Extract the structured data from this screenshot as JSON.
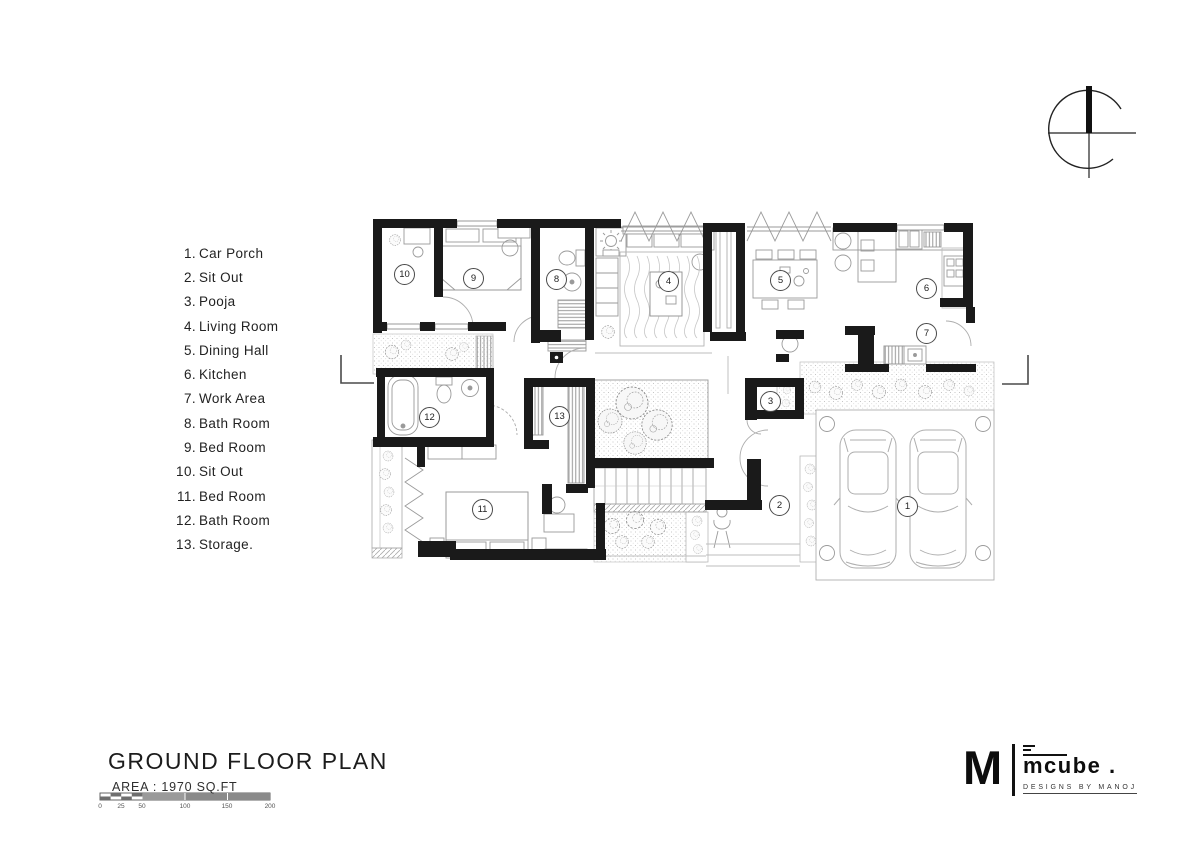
{
  "legend": {
    "items": [
      {
        "number": "1.",
        "name": "Car Porch"
      },
      {
        "number": "2.",
        "name": "Sit Out"
      },
      {
        "number": "3.",
        "name": "Pooja"
      },
      {
        "number": "4.",
        "name": "Living Room"
      },
      {
        "number": "5.",
        "name": "Dining Hall"
      },
      {
        "number": "6.",
        "name": "Kitchen"
      },
      {
        "number": "7.",
        "name": "Work Area"
      },
      {
        "number": "8.",
        "name": "Bath Room"
      },
      {
        "number": "9.",
        "name": "Bed Room"
      },
      {
        "number": "10.",
        "name": "Sit Out"
      },
      {
        "number": "11.",
        "name": "Bed Room"
      },
      {
        "number": "12.",
        "name": "Bath Room"
      },
      {
        "number": "13.",
        "name": "Storage."
      }
    ]
  },
  "plan": {
    "room_tags": [
      "1",
      "2",
      "3",
      "4",
      "5",
      "6",
      "7",
      "8",
      "9",
      "10",
      "11",
      "12",
      "13"
    ]
  },
  "title_block": {
    "title": "GROUND FLOOR PLAN",
    "area_label": "AREA : 1970 SQ.FT",
    "scale_labels": [
      "0",
      "25",
      "50",
      "100",
      "150",
      "200"
    ]
  },
  "logo": {
    "monogram": "M",
    "brand": "mcube .",
    "tagline": "DESIGNS BY MANOJ"
  },
  "colors": {
    "ink": "#1a1a1a",
    "wall": "#1a1a1a",
    "thin_line": "#9a9a9a",
    "stipple": "#b9b9b9"
  }
}
